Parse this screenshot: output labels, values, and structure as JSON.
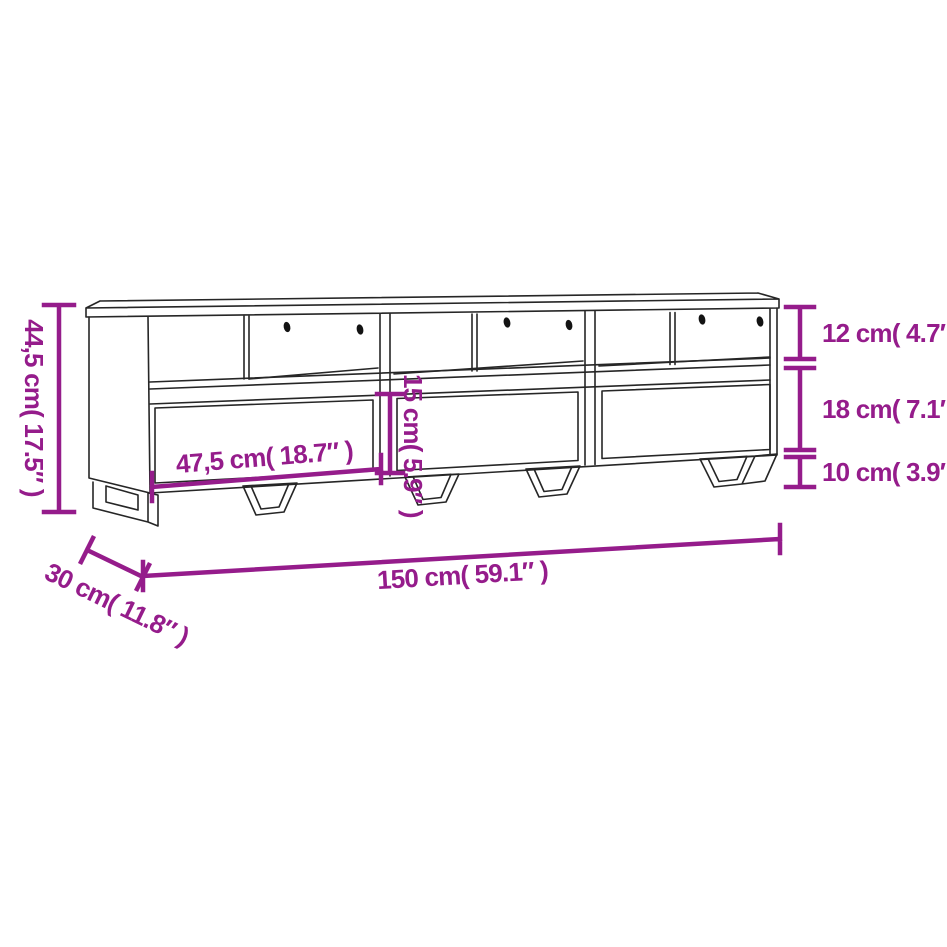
{
  "image": {
    "type": "product-dimension-diagram",
    "subject": "TV cabinet with 3 open compartments, 3 drawers and metal sled legs",
    "background_color": "#ffffff",
    "sketch_line_color": "#262626",
    "accent_color": "#951C8B",
    "sections": 3,
    "cable_holes_per_section": 2
  },
  "dimensions": {
    "total_height": "44,5 cm( 17.5″ )",
    "compartment_height": "12 cm( 4.7″ )",
    "drawer_front_height": "18 cm( 7.1″ )",
    "leg_height": "10 cm( 3.9″ )",
    "drawer_opening_height": "15 cm( 5.9″ )",
    "drawer_width": "47,5 cm( 18.7″ )",
    "total_width": "150 cm( 59.1″ )",
    "depth": "30 cm( 11.8″ )"
  }
}
